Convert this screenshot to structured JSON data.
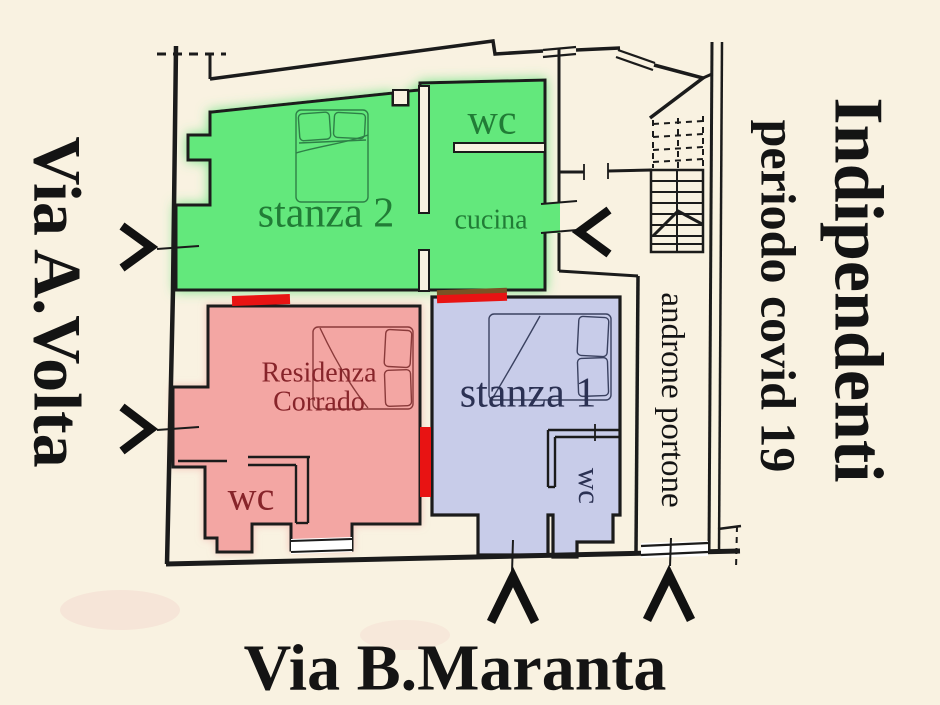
{
  "streets": {
    "left": "Via A.Volta",
    "bottom": "Via B.Maranta"
  },
  "annotation": {
    "title": "Indipendenti",
    "subtitle": "periodo covid 19"
  },
  "corridor": {
    "label": "androne portone"
  },
  "rooms": {
    "stanza2": {
      "name": "stanza 2",
      "wc": "wc",
      "cucina": "cucina"
    },
    "residenza": {
      "name_line1": "Residenza",
      "name_line2": "Corrado",
      "wc": "wc"
    },
    "stanza1": {
      "name": "stanza 1",
      "wc": "wc"
    }
  },
  "palette": {
    "background": "#f9f2e1",
    "wall": "#1b1b1b",
    "room_green_fill": "#63e87b",
    "room_green_label": "#217c36",
    "room_red_fill": "#f3a6a3",
    "room_red_label": "#87242a",
    "room_blue_fill": "#c8cce9",
    "room_blue_label": "#2b3153",
    "door_marker": "#e81313",
    "door_marker_dark": "#7a5224",
    "street_text": "#141414",
    "bed_green_stroke": "#2e8047",
    "bed_red_stroke": "#8a3a3a",
    "bed_blue_stroke": "#3a4160"
  }
}
